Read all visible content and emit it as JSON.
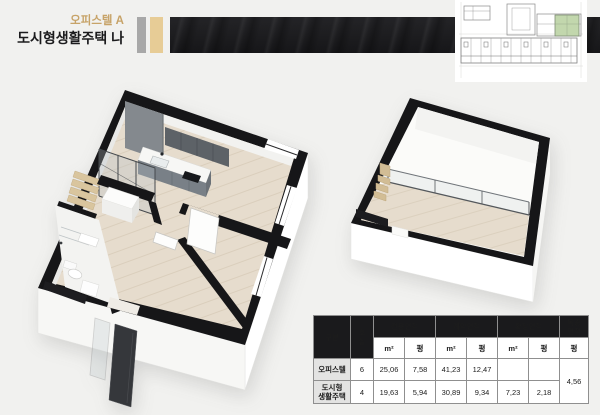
{
  "theme": {
    "page_bg": "#f1f1ef",
    "gold": "#c7a368",
    "bar_gray": "#a8a8a8",
    "bar_gold": "#e7cc96",
    "banner": "#1b1b1e",
    "wall": "#161618",
    "wood": "#e6dccd",
    "green": "#c2d7ad",
    "hdr_bg": "#1a1a1c",
    "label_bg": "#e3e3e2"
  },
  "header": {
    "title_small": "오피스텔 A",
    "title_large": "도시형생활주택 나"
  },
  "keyplan": {
    "description": "building-key-plan-with-highlighted-unit",
    "highlight_color": "#c2d7ad"
  },
  "floorplans": {
    "main": "main-unit-3d-isometric-floor-plan",
    "loft": "duplex-upper-level-3d-isometric-floor-plan"
  },
  "table": {
    "headers": {
      "category": "구분",
      "room": "호\n실",
      "exclusive": "전용면적",
      "contract": "계약면적",
      "expansion": "확장면적",
      "duplex": "복층\n면적",
      "m2": "m²",
      "py": "평"
    },
    "rows": [
      {
        "category": "오피스텔",
        "room": "6",
        "exclusive_m2": "25,06",
        "exclusive_py": "7,58",
        "contract_m2": "41,23",
        "contract_py": "12,47",
        "expansion_m2": "",
        "expansion_py": "",
        "duplex_py": "4,56"
      },
      {
        "category": "도시형\n생활주택",
        "room": "4",
        "exclusive_m2": "19,63",
        "exclusive_py": "5,94",
        "contract_m2": "30,89",
        "contract_py": "9,34",
        "expansion_m2": "7,23",
        "expansion_py": "2,18"
      }
    ]
  }
}
